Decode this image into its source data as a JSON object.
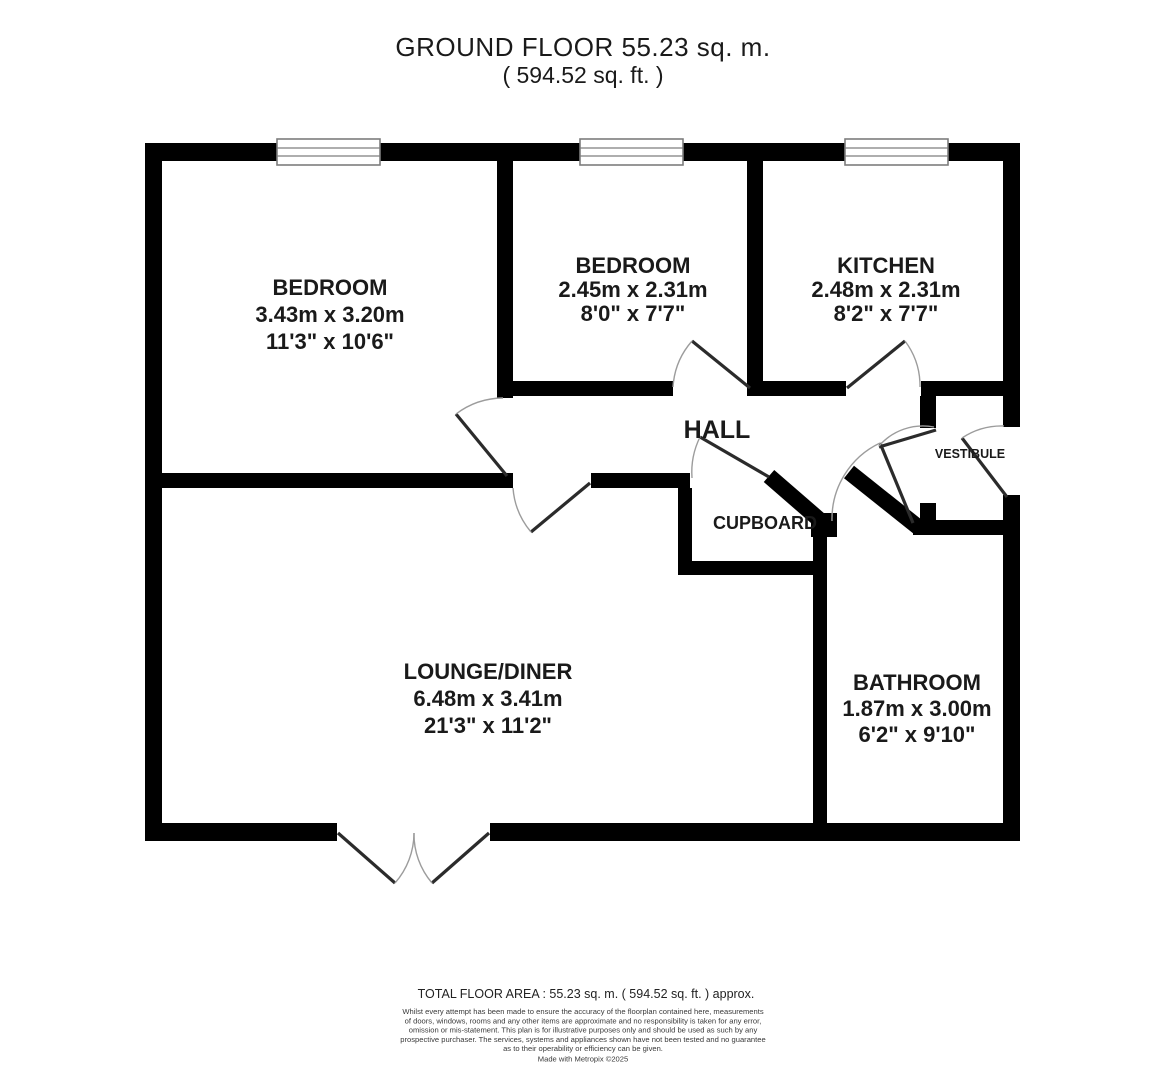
{
  "title": {
    "line1": "GROUND FLOOR 55.23 sq. m.",
    "line2": "( 594.52 sq. ft. )"
  },
  "rooms": {
    "bedroom1": {
      "name": "BEDROOM",
      "metric": "3.43m x 3.20m",
      "imperial": "11'3\" x 10'6\""
    },
    "bedroom2": {
      "name": "BEDROOM",
      "metric": "2.45m x 2.31m",
      "imperial": "8'0\" x 7'7\""
    },
    "kitchen": {
      "name": "KITCHEN",
      "metric": "2.48m x 2.31m",
      "imperial": "8'2\" x 7'7\""
    },
    "hall": {
      "name": "HALL"
    },
    "vestibule": {
      "name": "VESTIBULE"
    },
    "cupboard": {
      "name": "CUPBOARD"
    },
    "lounge": {
      "name": "LOUNGE/DINER",
      "metric": "6.48m x 3.41m",
      "imperial": "21'3\" x 11'2\""
    },
    "bathroom": {
      "name": "BATHROOM",
      "metric": "1.87m x 3.00m",
      "imperial": "6'2\" x 9'10\""
    }
  },
  "footer": {
    "total": "TOTAL FLOOR AREA : 55.23 sq. m. ( 594.52 sq. ft. ) approx.",
    "disclaimer": [
      "Whilst every attempt has been made to ensure the accuracy of the floorplan contained here, measurements",
      "of doors, windows, rooms and any other items are approximate and no responsibility is taken for any error,",
      "omission or mis-statement. This plan is for illustrative purposes only and should be used as such by any",
      "prospective purchaser. The services, systems and appliances shown have not been tested and no guarantee",
      "as to their operability or efficiency can be given."
    ],
    "credit": "Made with Metropix ©2025"
  },
  "colors": {
    "wall": "#000000",
    "door_leaf": "#2b2b2b",
    "door_arc": "#9c9c9c",
    "window_border": "#7d7d7d"
  }
}
